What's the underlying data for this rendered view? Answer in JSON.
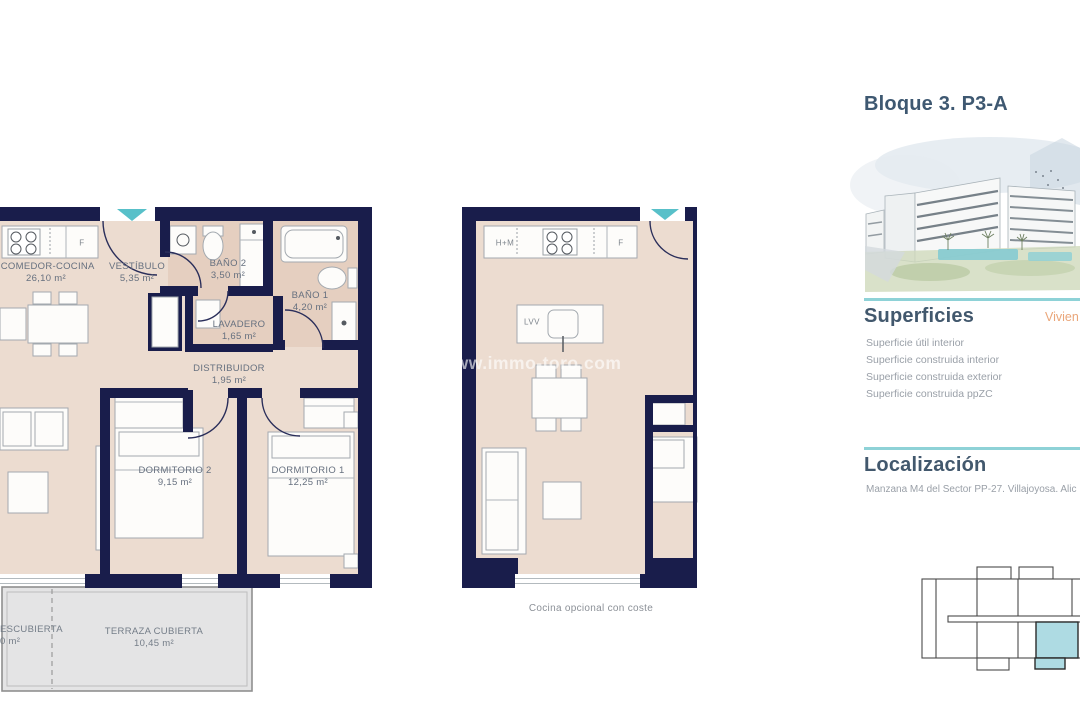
{
  "floorplan_main": {
    "rooms": [
      {
        "name": "-COMEDOR-COCINA",
        "area": "26,10 m²"
      },
      {
        "name": "VESTÍBULO",
        "area": "5,35 m²"
      },
      {
        "name": "BAÑO 2",
        "area": "3,50 m²"
      },
      {
        "name": "BAÑO 1",
        "area": "4,20 m²"
      },
      {
        "name": "LAVADERO",
        "area": "1,65 m²"
      },
      {
        "name": "DISTRIBUIDOR",
        "area": "1,95 m²"
      },
      {
        "name": "DORMITORIO 2",
        "area": "9,15 m²"
      },
      {
        "name": "DORMITORIO 1",
        "area": "12,25 m²"
      },
      {
        "name": "ESCUBIERTA",
        "area": "0 m²"
      },
      {
        "name": "TERRAZA CUBIERTA",
        "area": "10,45 m²"
      }
    ],
    "fixture_labels": {
      "fridge": "F"
    }
  },
  "floorplan_optional": {
    "caption": "Cocina opcional con coste",
    "fixture_labels": {
      "hm": "H+M",
      "fridge": "F",
      "island": "LVV"
    }
  },
  "watermark": "www.immo-toro.com",
  "sidebar": {
    "title": "Bloque 3. P3-A",
    "superficies": {
      "heading": "Superficies",
      "column_tag": "Vivien",
      "items": [
        "Superficie útil interior",
        "Superficie construida interior",
        "Superficie construida exterior",
        "Superficie construida ppZC"
      ]
    },
    "localizacion": {
      "heading": "Localización",
      "text": "Manzana M4 del Sector PP-27. Villajoyosa. Alic"
    }
  },
  "colors": {
    "wall_navy": "#191d4b",
    "floor_beige": "#ecdcd0",
    "bath_beige": "#e5cfc0",
    "terrace_gray": "#e4e4e5",
    "accent_teal": "#58c0c9",
    "divider_teal": "#8ed2d7",
    "heading_slate": "#3e5871",
    "tag_orange": "#eaa679",
    "keyplan_highlight": "#aedbe3"
  }
}
